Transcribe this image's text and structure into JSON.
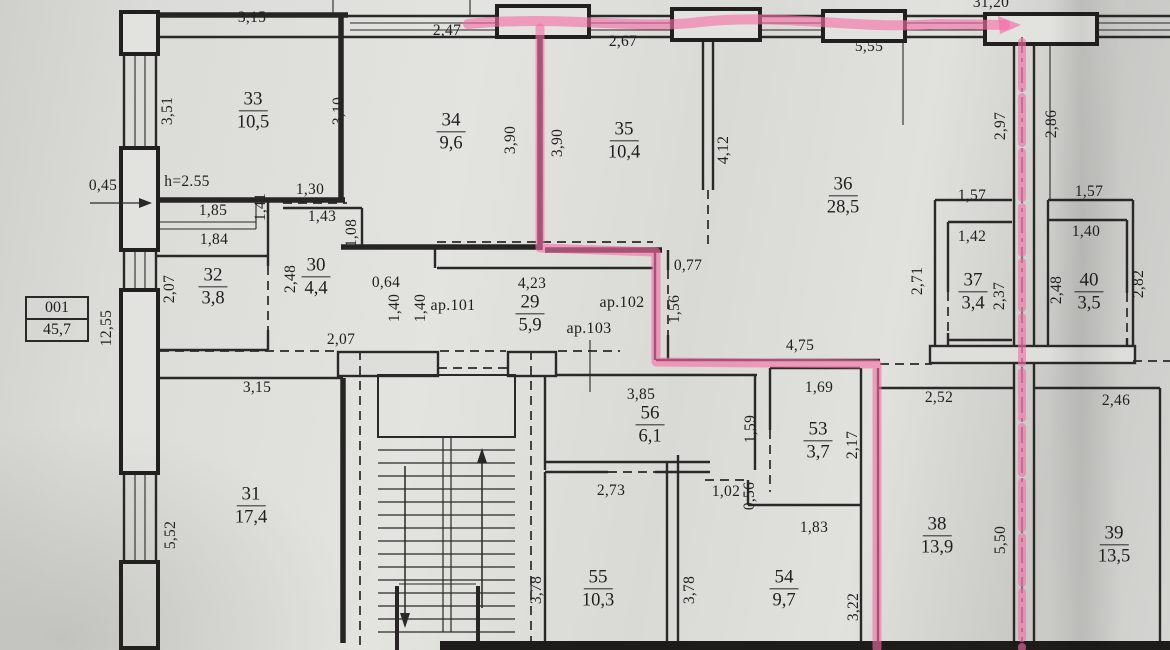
{
  "drawing_type": "apartment floor plan (scanned, pink highlighter route)",
  "legend": {
    "code": "001",
    "total_area": "45,7"
  },
  "notes": {
    "ceiling_height": "h=2.55"
  },
  "apartments": {
    "a101": "ар.101",
    "a102": "ар.102",
    "a103": "ар.103"
  },
  "rooms": [
    {
      "number": "29",
      "area": "5,9"
    },
    {
      "number": "30",
      "area": "4,4"
    },
    {
      "number": "31",
      "area": "17,4"
    },
    {
      "number": "32",
      "area": "3,8"
    },
    {
      "number": "33",
      "area": "10,5"
    },
    {
      "number": "34",
      "area": "9,6"
    },
    {
      "number": "35",
      "area": "10,4"
    },
    {
      "number": "36",
      "area": "28,5"
    },
    {
      "number": "37",
      "area": "3,4"
    },
    {
      "number": "38",
      "area": "13,9"
    },
    {
      "number": "39",
      "area": "13,5"
    },
    {
      "number": "40",
      "area": "3,5"
    },
    {
      "number": "53",
      "area": "3,7"
    },
    {
      "number": "54",
      "area": "9,7"
    },
    {
      "number": "55",
      "area": "10,3"
    },
    {
      "number": "56",
      "area": "6,1"
    }
  ],
  "dimensions": {
    "top_room33": "3,15",
    "top_room34": "2,47",
    "top_room35": "2,67",
    "top_right": "5,55",
    "top_total": "31,20",
    "left_upper": "3,51",
    "left_total": "12,55",
    "left_lower": "5,52",
    "wall_offset": "0,45",
    "room33_right": "3,10",
    "room34_right": "3,90",
    "room35_left": "3,90",
    "room35_right": "4,12",
    "hall_width_upper": "1,85",
    "hall_width_lower": "1,84",
    "hall_door": "1,41",
    "room30_door_top": "1,30",
    "room30_top": "1,43",
    "room30_left": "1,08",
    "room30_door_side": "2,48",
    "room32_left": "2,07",
    "room32_bottom": "2,07",
    "room31_top": "3,15",
    "corridor_offset": "0,64",
    "corridor_door1": "1,40",
    "corridor_door2": "1,40",
    "corridor_length": "4,23",
    "corridor_door_right": "1,56",
    "room36_notch": "0,77",
    "corridor_south": "4,75",
    "shaft_left": "2,97",
    "shaft_right": "2,86",
    "room37_outer": "1,57",
    "room40_outer": "1,57",
    "room37_top": "1,42",
    "room40_top": "1,40",
    "room37_left": "2,71",
    "room37_right": "2,37",
    "room40_left": "2,48",
    "room40_right": "2,82",
    "room38_top": "2,52",
    "room39_top": "2,46",
    "room38_right": "5,50",
    "room56_top": "3,85",
    "room56_right": "1,59",
    "room53_top": "1,69",
    "room53_right": "2,17",
    "room55_top": "2,73",
    "room55_left": "3,78",
    "room54_top": "1,83",
    "room54_left": "3,78",
    "room54_right": "3,22",
    "notch_width": "1,02",
    "notch_height": "0,56"
  },
  "highlight_color": "#f56ea6",
  "line_color": "#2a2927"
}
